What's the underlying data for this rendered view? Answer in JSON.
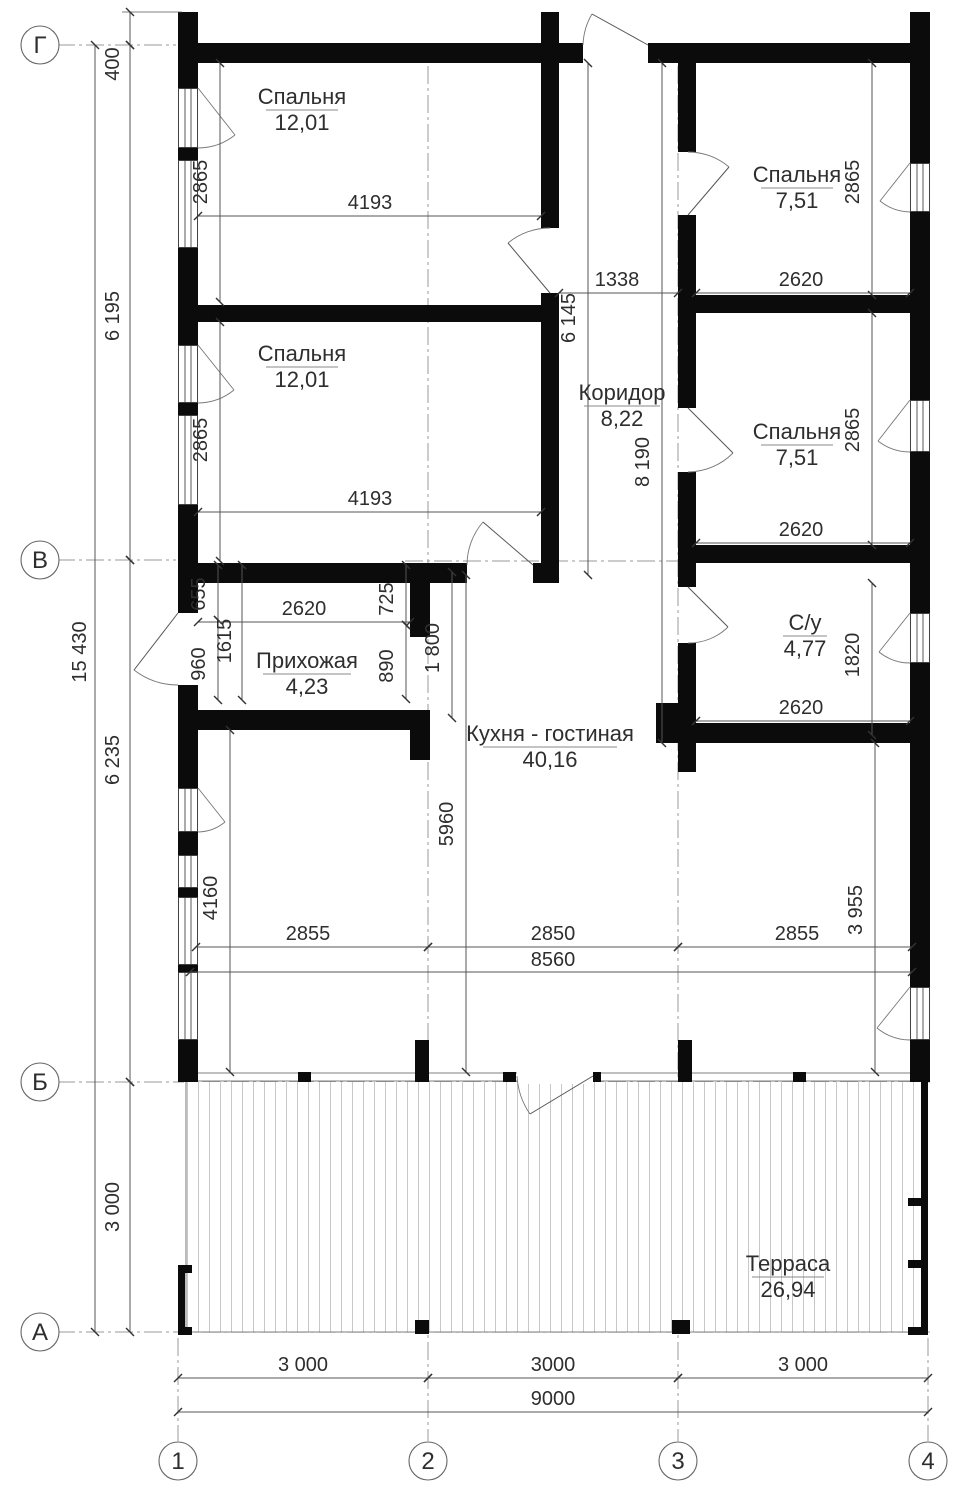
{
  "colors": {
    "wall": "#0b0b0b",
    "dimension_line": "#555555",
    "grid_line": "#999999",
    "hatch": "#cccccc",
    "text": "#2e2e2e",
    "background": "#ffffff"
  },
  "axes": {
    "rows": [
      {
        "label": "Г"
      },
      {
        "label": "В"
      },
      {
        "label": "Б"
      },
      {
        "label": "А"
      }
    ],
    "cols": [
      {
        "label": "1"
      },
      {
        "label": "2"
      },
      {
        "label": "3"
      },
      {
        "label": "4"
      }
    ]
  },
  "rooms": [
    {
      "name": "Спальня",
      "area": "12,01"
    },
    {
      "name": "Спальня",
      "area": "12,01"
    },
    {
      "name": "Спальня",
      "area": "7,51"
    },
    {
      "name": "Спальня",
      "area": "7,51"
    },
    {
      "name": "Коридор",
      "area": "8,22"
    },
    {
      "name": "Прихожая",
      "area": "4,23"
    },
    {
      "name": "С/у",
      "area": "4,77"
    },
    {
      "name": "Кухня - гостиная",
      "area": "40,16"
    },
    {
      "name": "Терраса",
      "area": "26,94"
    }
  ],
  "dimensions": {
    "offset_top": "400",
    "left_g_v": "6 195",
    "left_v_b": "6 235",
    "left_b_a": "3 000",
    "left_total": "15 430",
    "bed_l1_h": "2865",
    "bed_l1_w": "4193",
    "bed_l2_h": "2865",
    "bed_l2_w": "4193",
    "corridor_w": "1338",
    "corridor_h": "6 145",
    "corridor_full": "8 190",
    "bed_r1_h": "2865",
    "bed_r1_w": "2620",
    "bed_r2_h": "2865",
    "bed_r2_w": "2620",
    "wc_h": "1820",
    "wc_w": "2620",
    "hall_655": "655",
    "hall_960": "960",
    "hall_1615": "1615",
    "hall_w": "2620",
    "hall_725": "725",
    "hall_890": "890",
    "hall_1800": "1 800",
    "kitchen_5960": "5960",
    "kitchen_4160": "4160",
    "kitchen_3955": "3 955",
    "kitchen_2855a": "2855",
    "kitchen_2850": "2850",
    "kitchen_2855b": "2855",
    "kitchen_total": "8560",
    "bay_1": "3 000",
    "bay_2": "3000",
    "bay_3": "3 000",
    "total_width": "9000"
  }
}
